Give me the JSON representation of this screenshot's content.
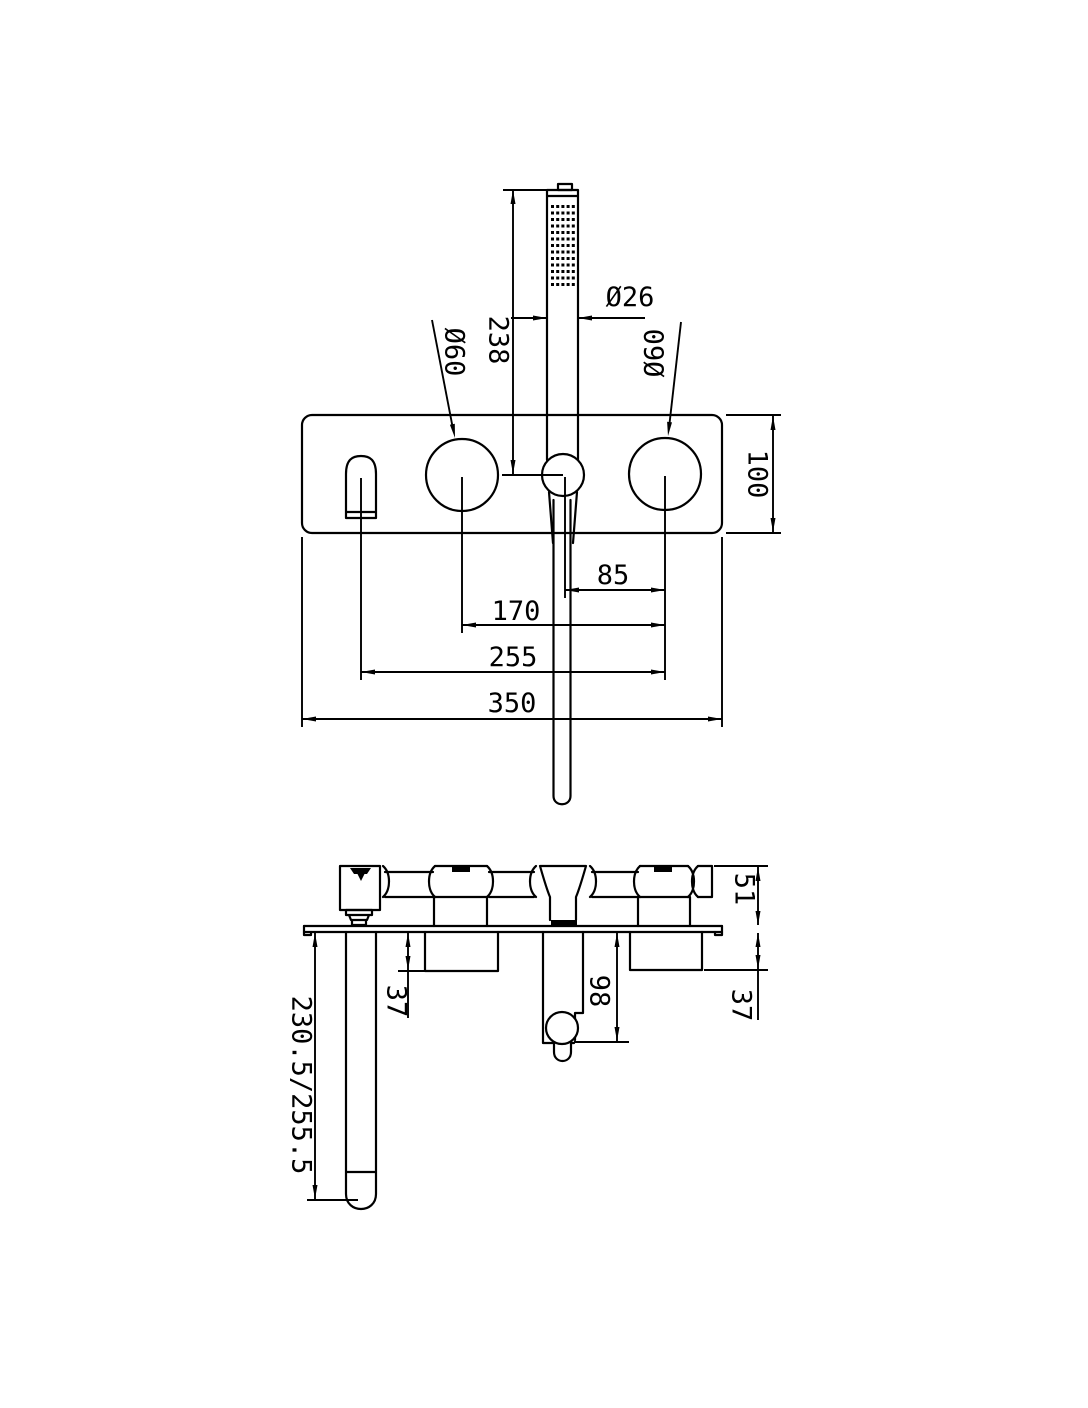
{
  "drawing": {
    "type": "technical-dimension-drawing",
    "subject": "wall-mounted bath/shower mixer with hand shower",
    "background": "#ffffff",
    "line_color": "#000000",
    "dimensions": {
      "front": {
        "hand_shower_height": "238",
        "hand_shower_diameter": "Ø26",
        "left_handle_diameter": "Ø60",
        "right_handle_diameter": "Ø60",
        "plate_height": "100",
        "shower_holder_to_right_handle": "85",
        "handle_to_handle": "170",
        "spout_to_right_handle": "255",
        "plate_width": "350"
      },
      "side": {
        "body_depth": "51",
        "left_valve_projection": "37",
        "right_valve_projection": "37",
        "shower_elbow_projection": "98",
        "spout_projection": "230.5/255.5"
      }
    }
  }
}
